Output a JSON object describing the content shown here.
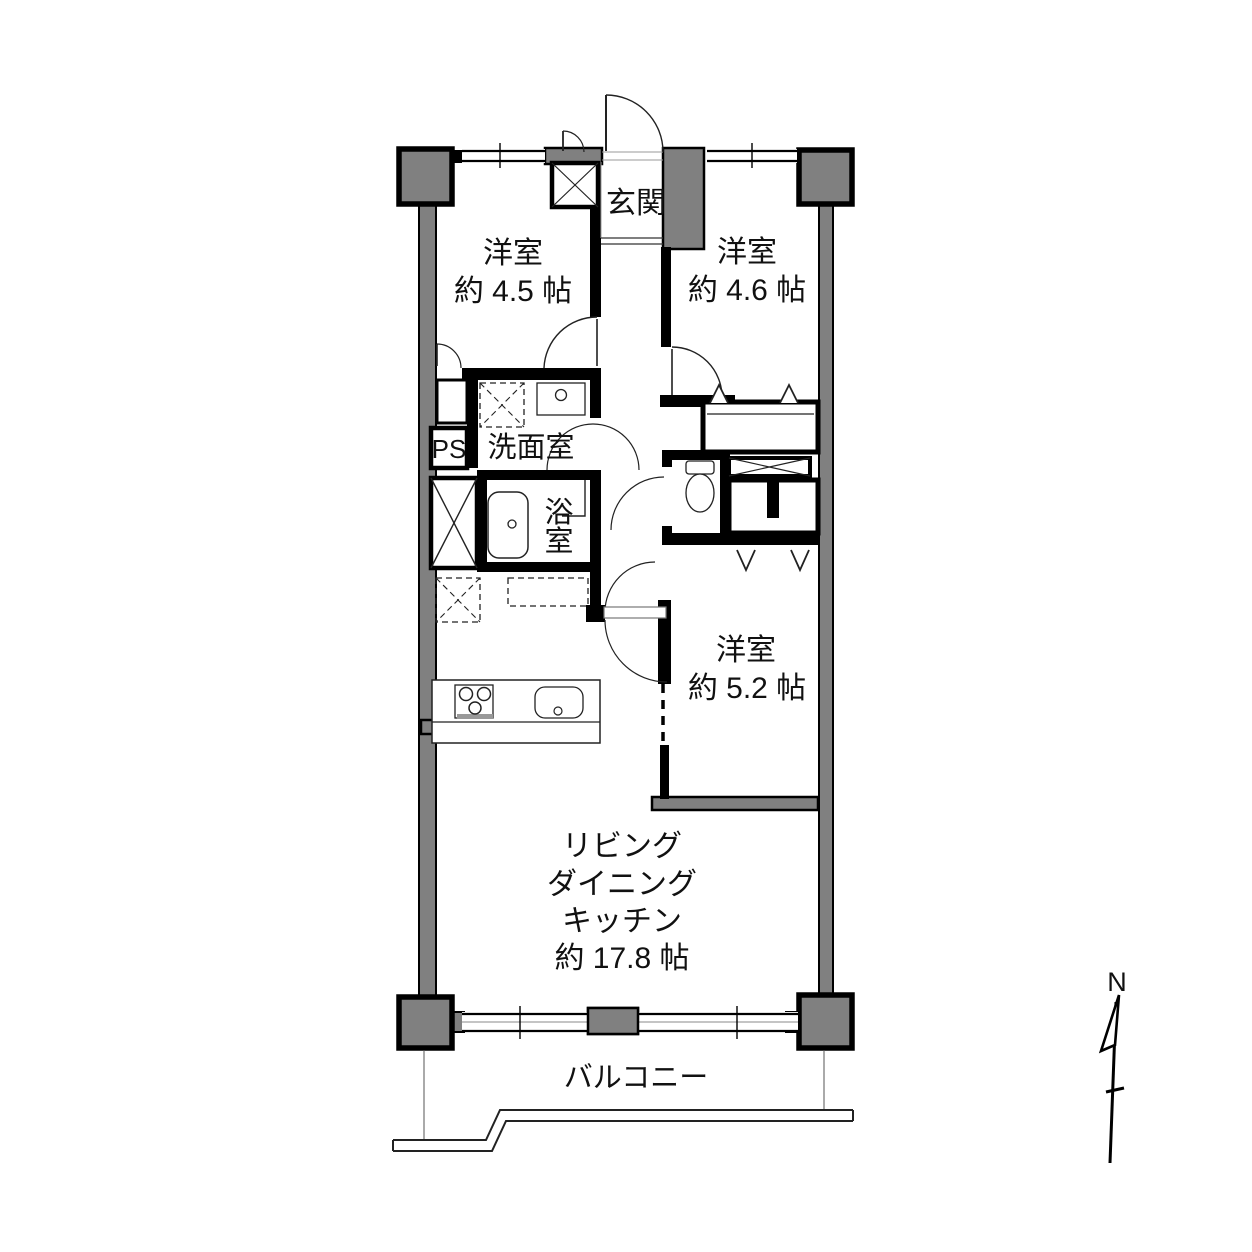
{
  "title": "間取り図",
  "colors": {
    "wall_gray": "#808080",
    "line_black": "#000000",
    "background": "#ffffff"
  },
  "compass": {
    "label": "N"
  },
  "rooms": {
    "genkan": {
      "label": "玄関"
    },
    "bedroom1": {
      "name": "洋室",
      "size": "約 4.5 帖"
    },
    "bedroom2": {
      "name": "洋室",
      "size": "約 4.6 帖"
    },
    "bedroom3": {
      "name": "洋室",
      "size": "約 5.2 帖"
    },
    "washroom": {
      "label": "洗面室"
    },
    "bathroom": {
      "char_top": "浴",
      "char_bottom": "室"
    },
    "pipe_space": {
      "label": "PS"
    },
    "ldk": {
      "line1": "リビング",
      "line2": "ダイニング",
      "line3": "キッチン",
      "line4": "約 17.8 帖"
    },
    "balcony": {
      "label": "バルコニー"
    }
  }
}
